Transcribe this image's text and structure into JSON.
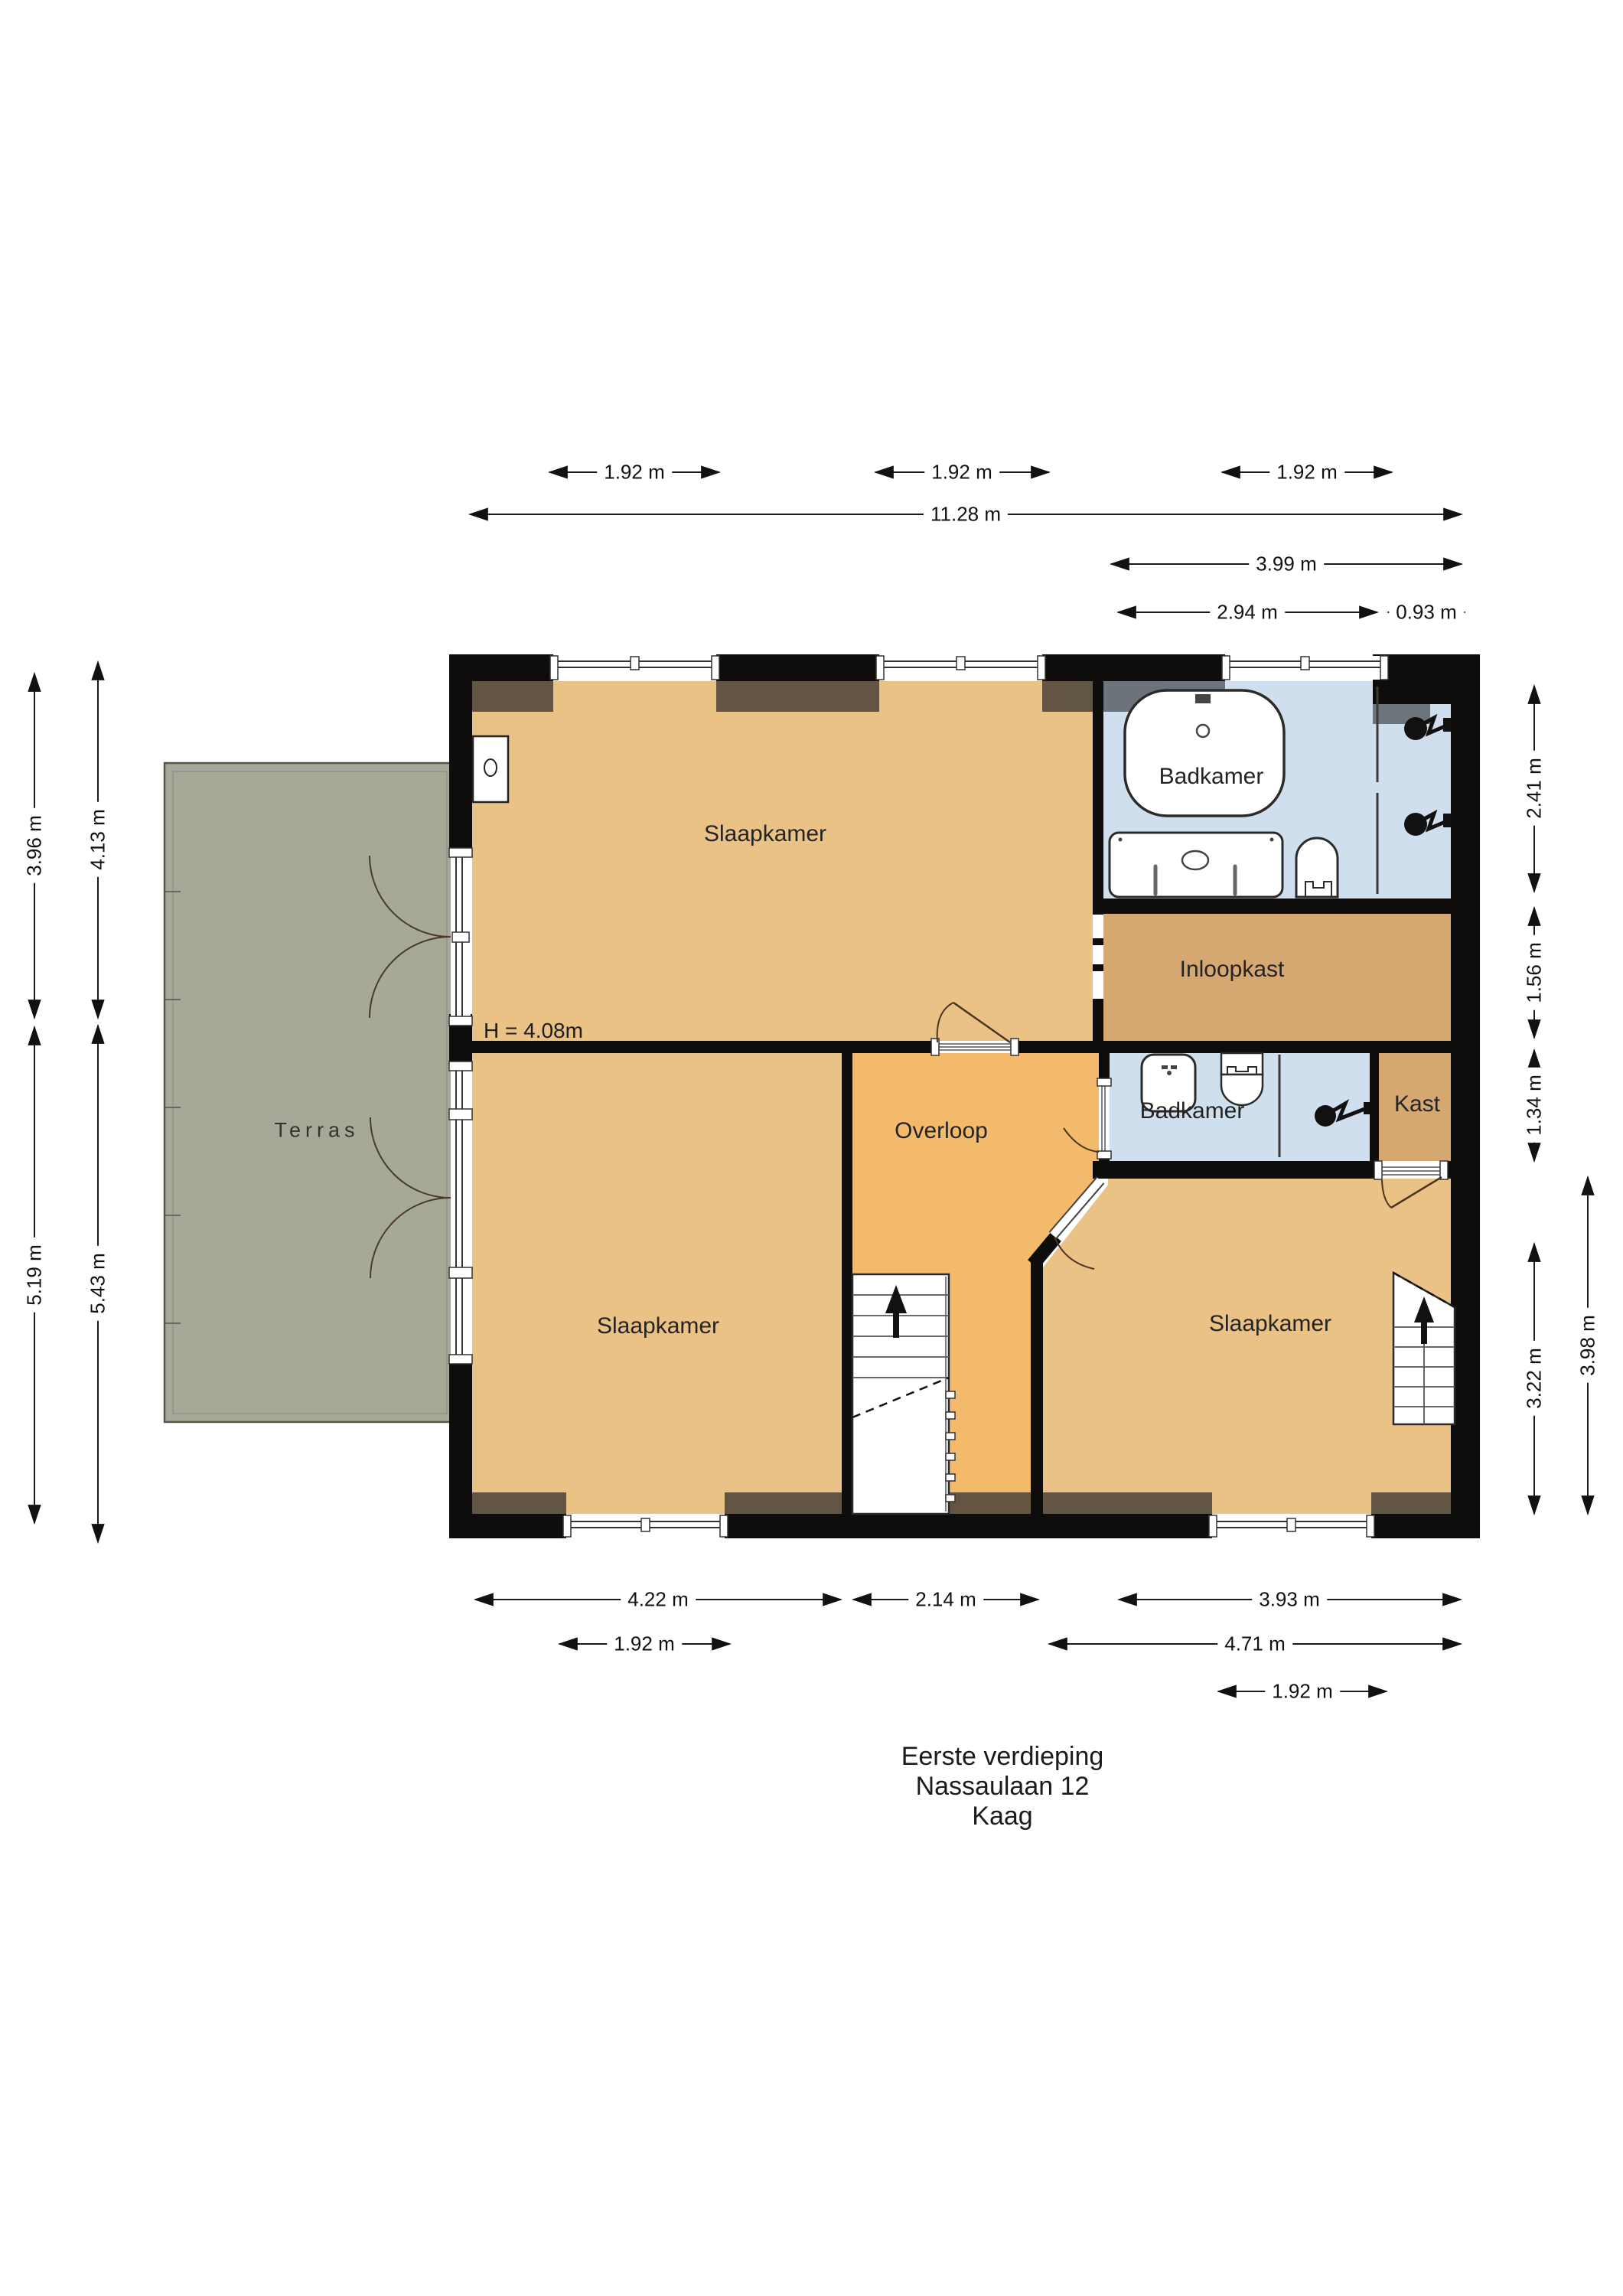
{
  "colors": {
    "wall": "#0e0d0b",
    "floor_tan": "#ebc286",
    "floor_orange": "#f4ba6c",
    "floor_closet": "#d5a872",
    "bath_blue": "#cfdfee",
    "terrace": "#a6a997",
    "shadow_brown": "#4a4238",
    "shadow_gray": "#5c6166",
    "white": "#ffffff"
  },
  "rooms": {
    "slaapkamer_top": "Slaapkamer",
    "badkamer_main": "Badkamer",
    "inloopkast": "Inloopkast",
    "badkamer_small": "Badkamer",
    "kast": "Kast",
    "overloop": "Overloop",
    "slaapkamer_left": "Slaapkamer",
    "slaapkamer_right": "Slaapkamer",
    "terras": "Terras"
  },
  "height_note": "H = 4.08m",
  "dims": {
    "m192": "1.92 m",
    "m1128": "11.28 m",
    "m399": "3.99 m",
    "m294": "2.94 m",
    "m093": "0.93 m",
    "m422": "4.22 m",
    "m214": "2.14 m",
    "m393": "3.93 m",
    "m471": "4.71 m",
    "m396": "3.96 m",
    "m519": "5.19 m",
    "m413": "4.13 m",
    "m543": "5.43 m",
    "m241": "2.41 m",
    "m156": "1.56 m",
    "m134": "1.34 m",
    "m322": "3.22 m",
    "m398": "3.98 m"
  },
  "title": {
    "line1": "Eerste verdieping",
    "line2": "Nassaulaan 12",
    "line3": "Kaag"
  }
}
